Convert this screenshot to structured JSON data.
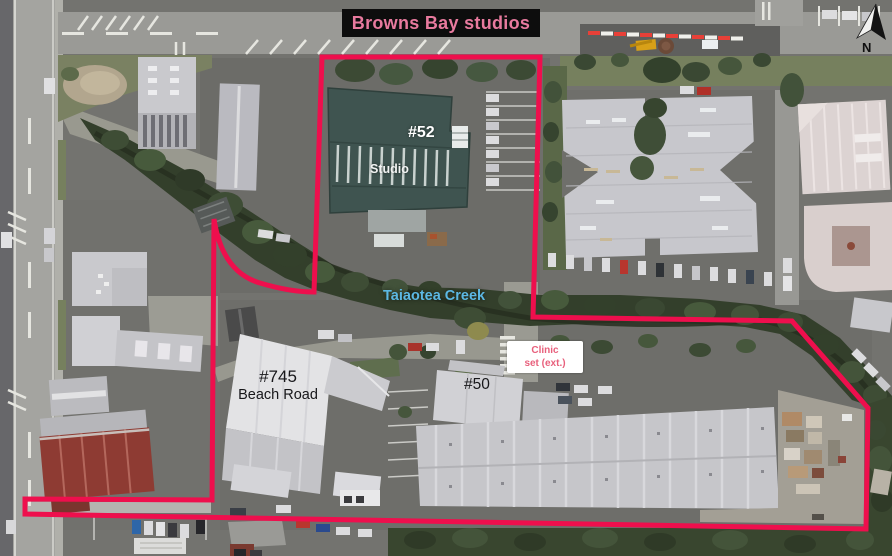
{
  "title": "Browns Bay studios",
  "compass": {
    "label": "N"
  },
  "annotations": {
    "studio_number": "#52",
    "studio_name": "Studio",
    "creek_name": "Taiaotea Creek",
    "clinic": {
      "line1": "Clinic",
      "line2": "set (ext.)"
    },
    "building_745": {
      "line1": "#745",
      "line2": "Beach Road"
    },
    "building_50": "#50"
  },
  "colors": {
    "boundary": "#ee0f4d",
    "title_text": "#e87a9e",
    "title_bg": "#0d0d0d",
    "creek_label": "#5cb8e4",
    "clinic_label": "#e8607c"
  }
}
